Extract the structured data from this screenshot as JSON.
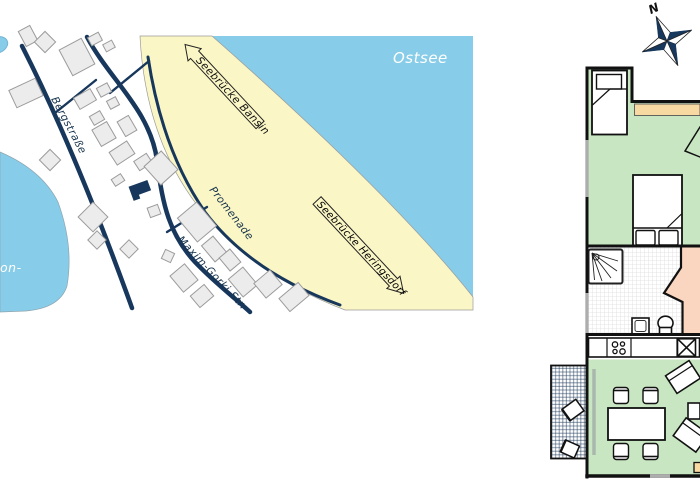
{
  "map": {
    "labels": {
      "sea": "Ostsee",
      "lake_fragment": "on-",
      "street_bergstrasse": "Bergstraße",
      "street_promenade": "Promenade",
      "street_maxim_gorki": "Maxim-Gorki-Str.",
      "pier_bansin": "Seebrücke Bansin",
      "pier_heringsdorf": "Seebrücke Heringsdorf"
    },
    "colors": {
      "water": "#87CCE8",
      "beach": "#FAF6C5",
      "street": "#17375C",
      "building_fill": "#ECECEC",
      "building_stroke": "#9B9B9B",
      "highlighted_building": "#17375C",
      "water_label_text": "#FFFFFF",
      "street_label_text": "#16334D"
    }
  },
  "floor_plan": {
    "compass_north_label": "N",
    "colors": {
      "living_floor_green": "#C8E6C1",
      "room_floor_pink": "#FAD5C0",
      "accent_tan": "#F8D9A2",
      "wall_black": "#111111",
      "window_gray": "#ADADAD",
      "compass_navy": "#17375C"
    }
  }
}
